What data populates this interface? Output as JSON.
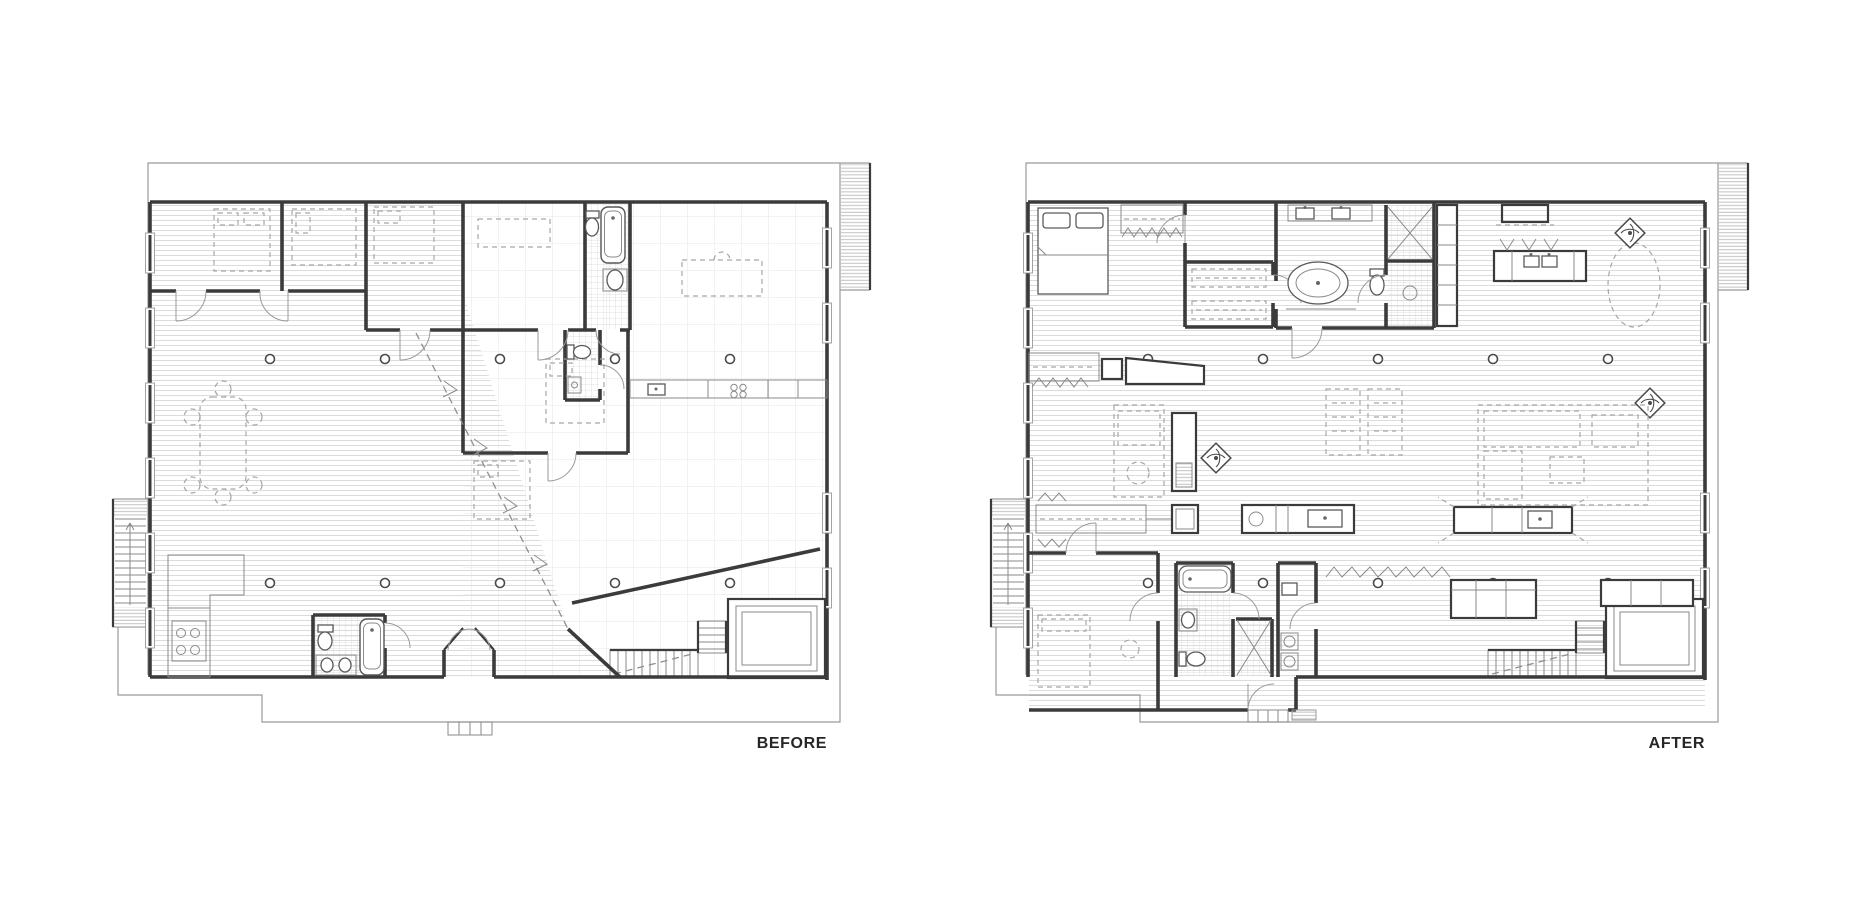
{
  "figure": {
    "kind": "architectural floor plan comparison",
    "background": "#ffffff"
  },
  "plans": [
    {
      "id": "before",
      "label": "BEFORE",
      "symbols": [
        "bed",
        "dining-table",
        "kitchen-counter",
        "stove-burners",
        "kitchen-sink",
        "bathtub",
        "toilet",
        "sink",
        "island",
        "stairs",
        "elevator",
        "column",
        "window",
        "door-swing",
        "demising-line",
        "exterior-stair"
      ]
    },
    {
      "id": "after",
      "label": "AFTER",
      "symbols": [
        "bed",
        "closet",
        "walk-in-closet",
        "double-vanity",
        "freestanding-tub",
        "shower",
        "toilet",
        "kitchen-range",
        "kitchen-island",
        "bar-stool",
        "dining-table",
        "ceiling-fan",
        "sofa",
        "rug",
        "media-console",
        "desk",
        "washer-dryer",
        "stairs",
        "elevator",
        "column",
        "window",
        "door-swing",
        "exterior-stair"
      ]
    }
  ],
  "colors": {
    "background": "#ffffff",
    "wall": "#3b3b3b",
    "thin_line": "#8a8a8a",
    "dashed_furniture": "#a6a6a6",
    "floor_hatch": "#dcdcdc",
    "tile_line": "#e4e4e4",
    "label_text": "#262626"
  }
}
